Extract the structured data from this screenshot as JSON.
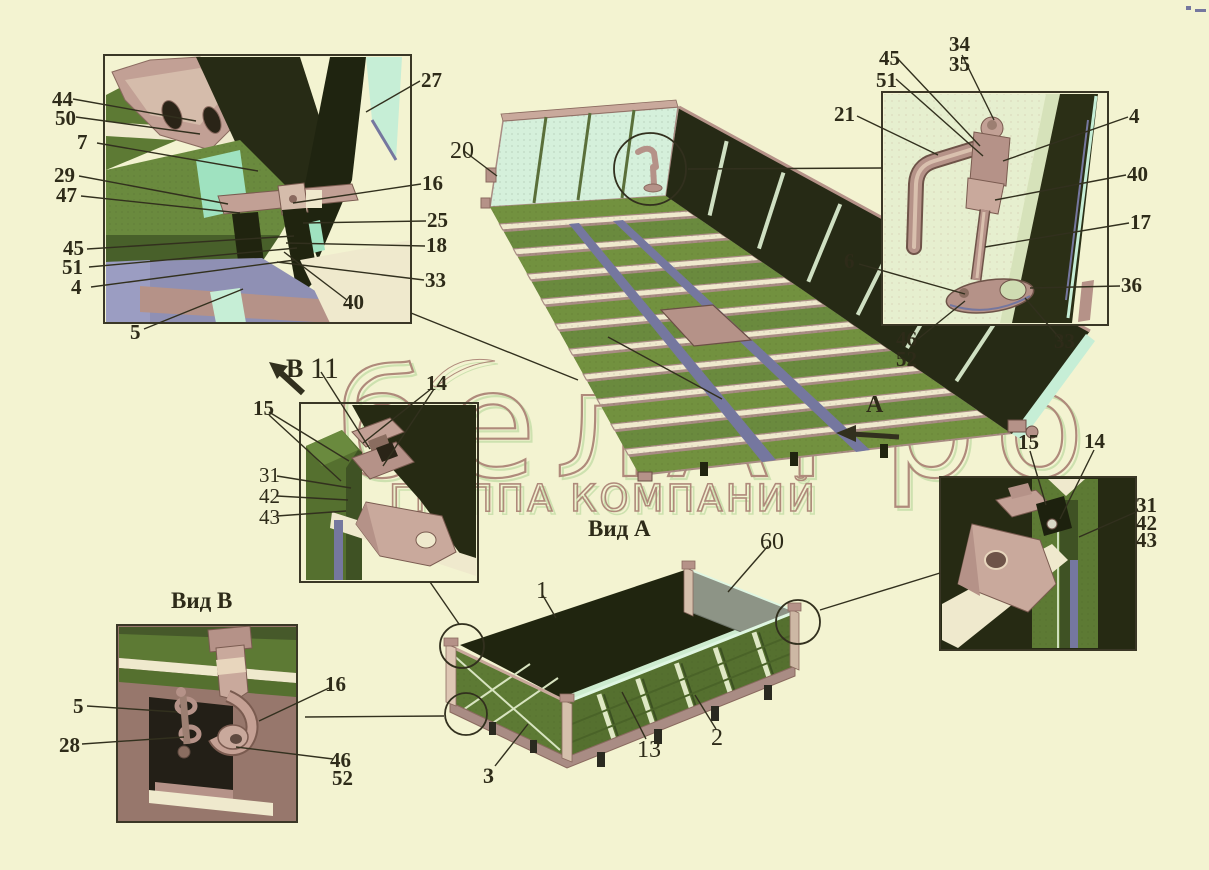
{
  "watermark": {
    "line1": "белАгро",
    "line2": "ГРУППА КОМПАНИЙ"
  },
  "views": {
    "view_a_title": "Вид А",
    "view_b_title": "Вид В",
    "arrow_a": "А",
    "arrow_b": "В"
  },
  "colors": {
    "background": "#f3f3d1",
    "ink": "#32301e",
    "mauve": "#b59288",
    "mauve_light": "#c9a99c",
    "dark_olive": "#272b15",
    "green": "#6a8a3e",
    "green_dark": "#55702f",
    "pale_panel": "#e6efcf",
    "mint": "#c6eed6",
    "blue": "#75779f",
    "cream": "#efe9cd",
    "watermark_outline": "#a87f72",
    "watermark_shadow": "#c9e0ac"
  },
  "callouts": [
    {
      "id": "44",
      "t": "44",
      "x": 52,
      "y": 90
    },
    {
      "id": "50",
      "t": "50",
      "x": 55,
      "y": 109
    },
    {
      "id": "7",
      "t": "7",
      "x": 77,
      "y": 133
    },
    {
      "id": "29",
      "t": "29",
      "x": 54,
      "y": 166
    },
    {
      "id": "47",
      "t": "47",
      "x": 56,
      "y": 186
    },
    {
      "id": "45-tl",
      "t": "45",
      "x": 63,
      "y": 239
    },
    {
      "id": "51-tl",
      "t": "51",
      "x": 62,
      "y": 258
    },
    {
      "id": "4-tl",
      "t": "4",
      "x": 71,
      "y": 278
    },
    {
      "id": "5-tl",
      "t": "5",
      "x": 130,
      "y": 323
    },
    {
      "id": "27",
      "t": "27",
      "x": 421,
      "y": 71
    },
    {
      "id": "16-tl",
      "t": "16",
      "x": 422,
      "y": 174
    },
    {
      "id": "25",
      "t": "25",
      "x": 427,
      "y": 211
    },
    {
      "id": "18",
      "t": "18",
      "x": 426,
      "y": 236
    },
    {
      "id": "33-tl",
      "t": "33",
      "x": 425,
      "y": 271
    },
    {
      "id": "40-tl",
      "t": "40",
      "x": 343,
      "y": 293
    },
    {
      "id": "20",
      "t": "20",
      "x": 450,
      "y": 140,
      "s": 24,
      "w": "n"
    },
    {
      "id": "45-tr",
      "t": "45",
      "x": 879,
      "y": 49
    },
    {
      "id": "51-tr",
      "t": "51",
      "x": 876,
      "y": 71
    },
    {
      "id": "34",
      "t": "34",
      "x": 949,
      "y": 35
    },
    {
      "id": "35",
      "t": "35",
      "x": 949,
      "y": 55
    },
    {
      "id": "21",
      "t": "21",
      "x": 834,
      "y": 105
    },
    {
      "id": "4-tr",
      "t": "4",
      "x": 1129,
      "y": 107
    },
    {
      "id": "40-tr",
      "t": "40",
      "x": 1127,
      "y": 165
    },
    {
      "id": "17",
      "t": "17",
      "x": 1130,
      "y": 213
    },
    {
      "id": "36",
      "t": "36",
      "x": 1121,
      "y": 276
    },
    {
      "id": "6",
      "t": "6",
      "x": 844,
      "y": 252
    },
    {
      "id": "46-tr",
      "t": "46",
      "x": 896,
      "y": 330
    },
    {
      "id": "52-tr",
      "t": "52",
      "x": 896,
      "y": 350
    },
    {
      "id": "33-tr",
      "t": "33",
      "x": 1054,
      "y": 332
    },
    {
      "id": "view-b-arrow",
      "t": "В",
      "x": 286,
      "y": 357,
      "s": 26
    },
    {
      "id": "11",
      "t": "11",
      "x": 310,
      "y": 355,
      "s": 30,
      "w": "n"
    },
    {
      "id": "14-ml",
      "t": "14",
      "x": 426,
      "y": 374
    },
    {
      "id": "15-ml",
      "t": "15",
      "x": 253,
      "y": 399
    },
    {
      "id": "31-ml",
      "t": "31",
      "x": 259,
      "y": 466,
      "w": "n"
    },
    {
      "id": "42-ml",
      "t": "42",
      "x": 259,
      "y": 487,
      "w": "n"
    },
    {
      "id": "43-ml",
      "t": "43",
      "x": 259,
      "y": 508,
      "w": "n"
    },
    {
      "id": "1",
      "t": "1",
      "x": 536,
      "y": 580,
      "s": 24,
      "w": "n"
    },
    {
      "id": "60",
      "t": "60",
      "x": 760,
      "y": 531,
      "s": 24,
      "w": "n"
    },
    {
      "id": "13",
      "t": "13",
      "x": 637,
      "y": 739,
      "s": 24,
      "w": "n"
    },
    {
      "id": "2",
      "t": "2",
      "x": 711,
      "y": 727,
      "s": 24,
      "w": "n"
    },
    {
      "id": "3",
      "t": "3",
      "x": 483,
      "y": 766,
      "s": 22
    },
    {
      "id": "view-a-arrow",
      "t": "А",
      "x": 866,
      "y": 394,
      "s": 24
    },
    {
      "id": "view-a-title",
      "t": "Вид А",
      "x": 588,
      "y": 518,
      "s": 23
    },
    {
      "id": "view-b-title",
      "t": "Вид В",
      "x": 171,
      "y": 590,
      "s": 23
    },
    {
      "id": "5-vb",
      "t": "5",
      "x": 73,
      "y": 697
    },
    {
      "id": "28",
      "t": "28",
      "x": 59,
      "y": 736
    },
    {
      "id": "16-vb",
      "t": "16",
      "x": 325,
      "y": 675
    },
    {
      "id": "46-vb",
      "t": "46",
      "x": 330,
      "y": 751
    },
    {
      "id": "52-vb",
      "t": "52",
      "x": 332,
      "y": 769
    },
    {
      "id": "15-br",
      "t": "15",
      "x": 1018,
      "y": 433
    },
    {
      "id": "14-br",
      "t": "14",
      "x": 1084,
      "y": 432
    },
    {
      "id": "31-br",
      "t": "31",
      "x": 1136,
      "y": 496
    },
    {
      "id": "42-br",
      "t": "42",
      "x": 1136,
      "y": 514
    },
    {
      "id": "43-br",
      "t": "43",
      "x": 1136,
      "y": 531
    }
  ]
}
